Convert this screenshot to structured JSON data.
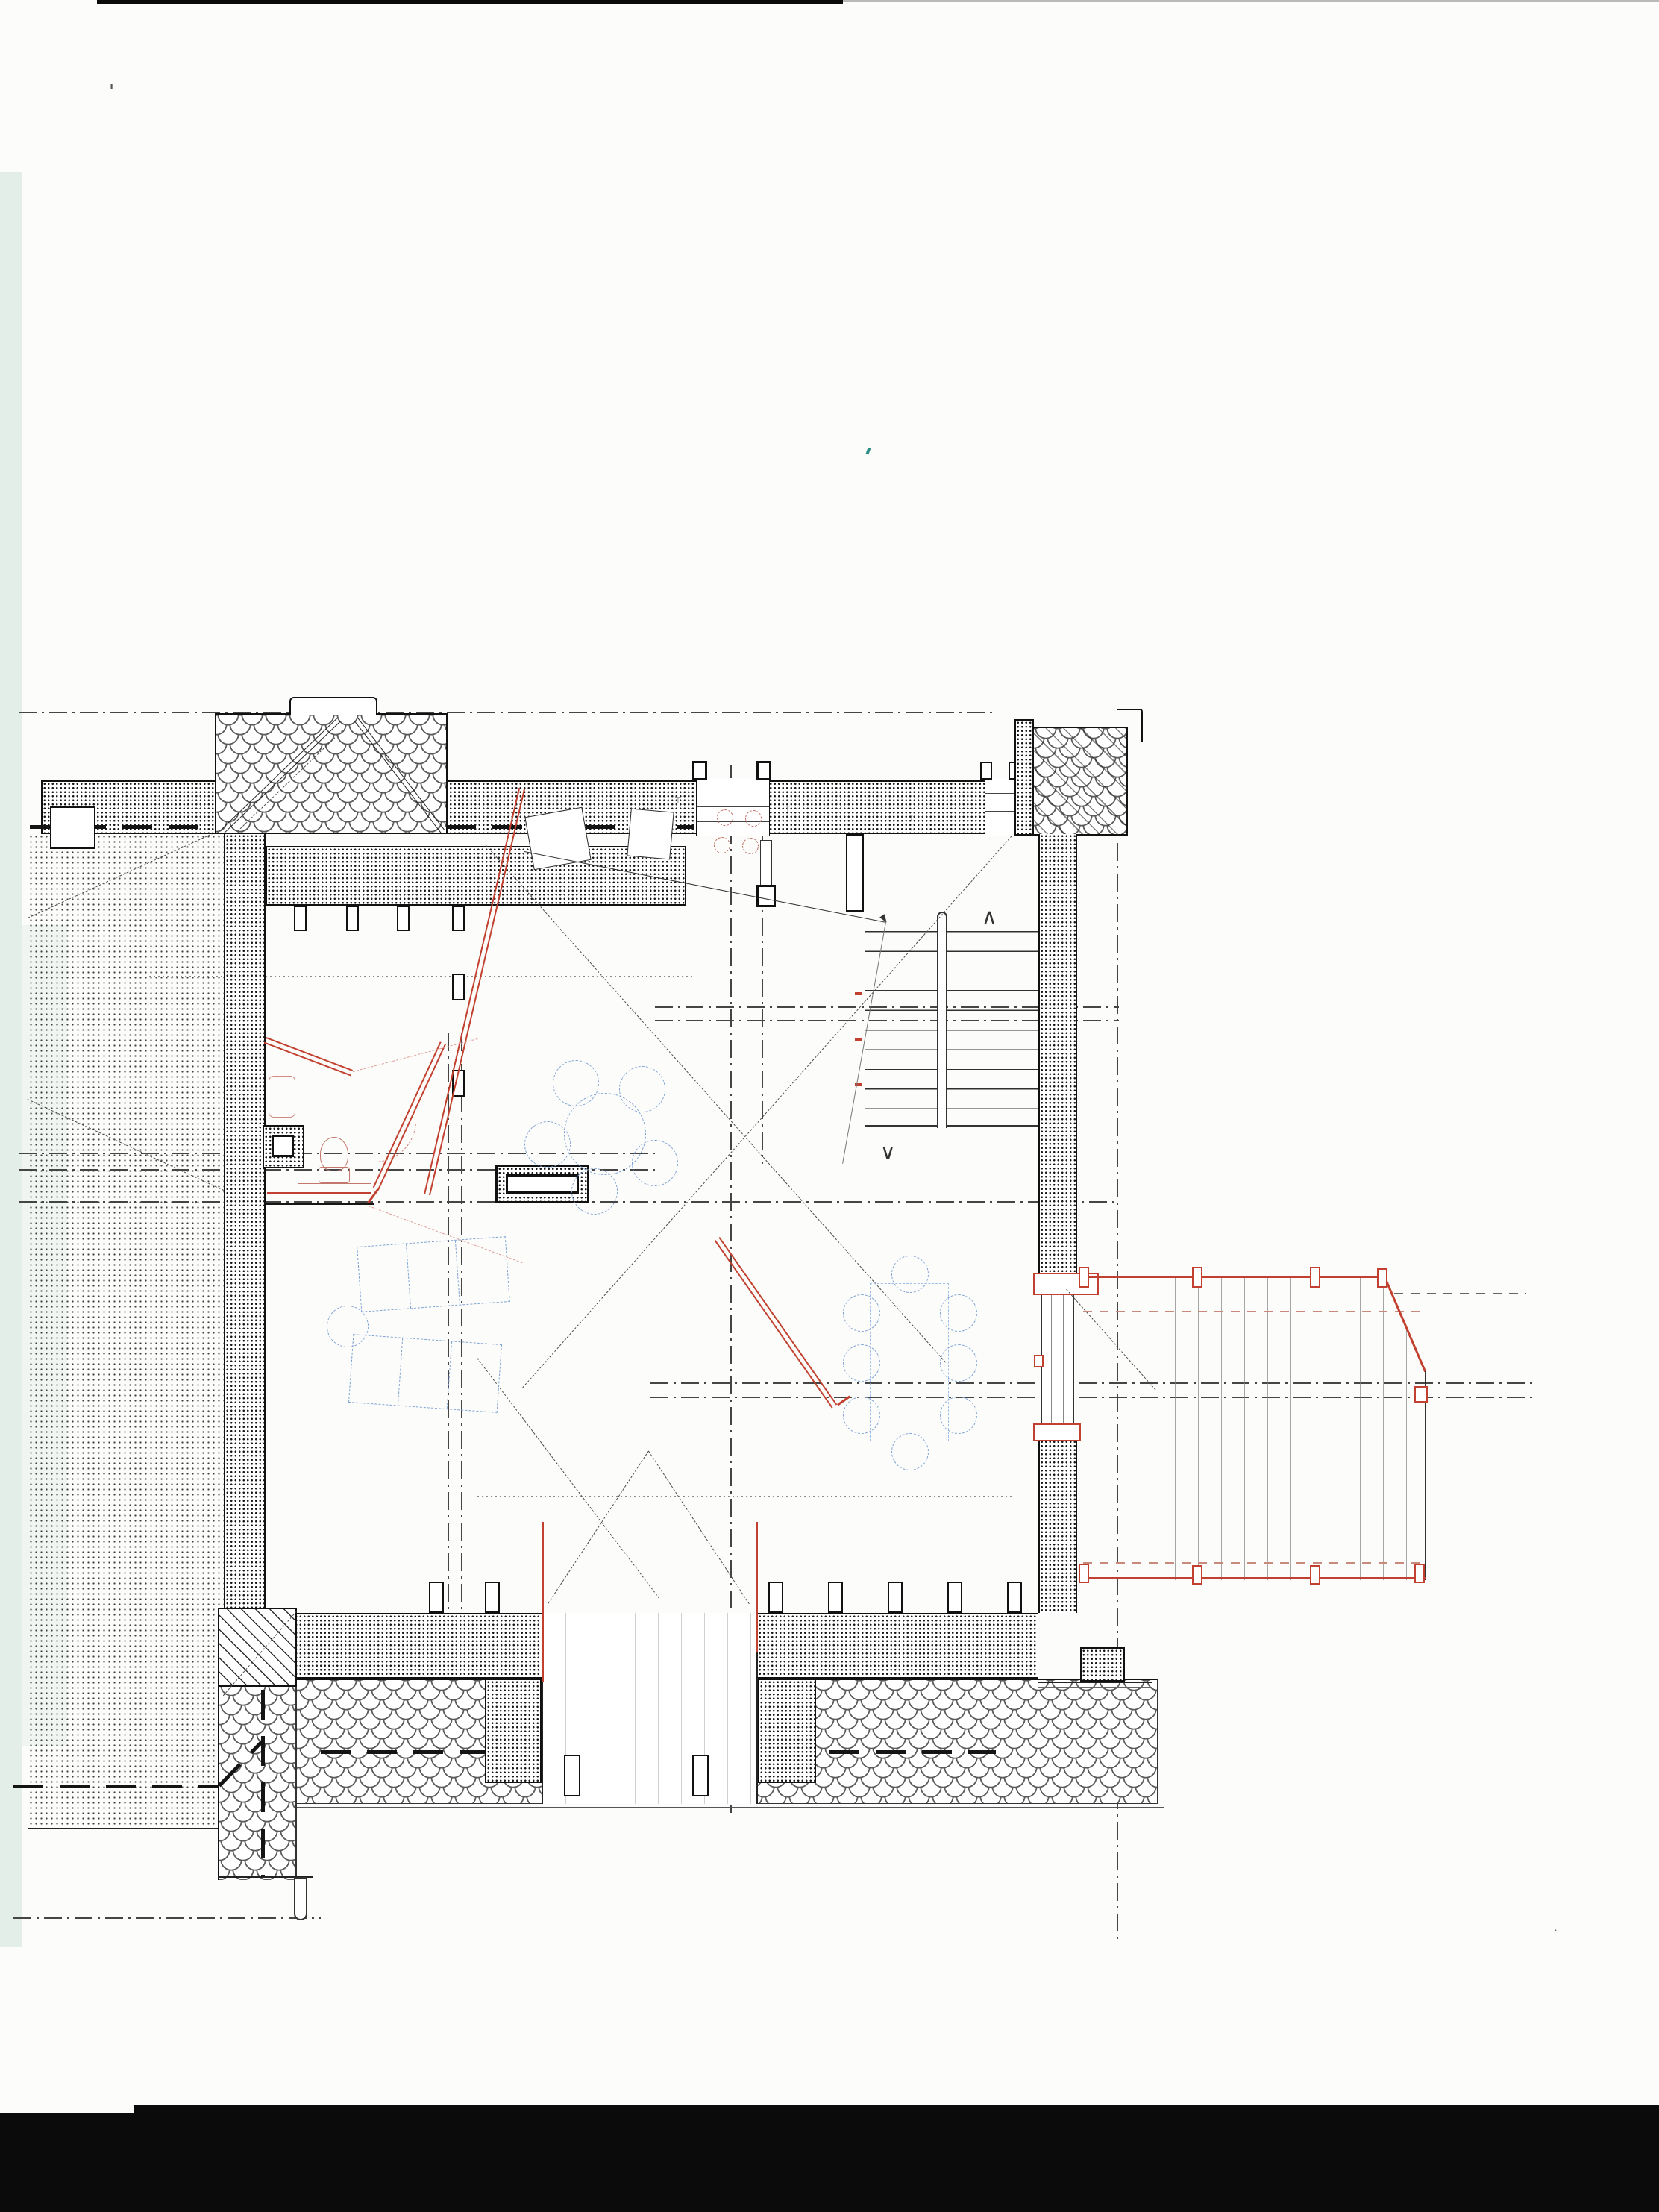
{
  "document": {
    "kind": "architectural floor plan, scanned pencil-and-ink drawing",
    "view": "attic floor plan with adjoining roof surfaces",
    "sheet_background": "white paper, black scan band at bottom edge",
    "text_labels_present": false
  },
  "colors": {
    "paper": "#fcfcfa",
    "ink": "#1c1c1c",
    "ink-soft": "#5a5a5a",
    "red": "#c2402f",
    "red-soft": "#cf8076",
    "pink": "#dd9a90",
    "blue": "#7fa3d4",
    "tint": "#e3eee8",
    "scan-black": "#0b0b0b"
  },
  "legend": {
    "dense_dot_hatch": "masonry walls cut in section (existing)",
    "light_dot_hatch": "adjoining lower roof surface",
    "fish_scale_hatch": "shingled roof eave band",
    "diagonal_hatch": "hipped roof corner piece",
    "red_double_lines": "new partition walls / renovation items",
    "blue_dashed_outlines": "loose furniture proposal",
    "thin_dash_dot_lines": "reference axes and roof projection lines"
  },
  "stairs": {
    "up_arrow": "∧",
    "down_arrow": "∨",
    "treads_visible": 10
  },
  "symbols": {
    "tee_mark": "┬",
    "scan_mark": "'",
    "speck": "·"
  }
}
